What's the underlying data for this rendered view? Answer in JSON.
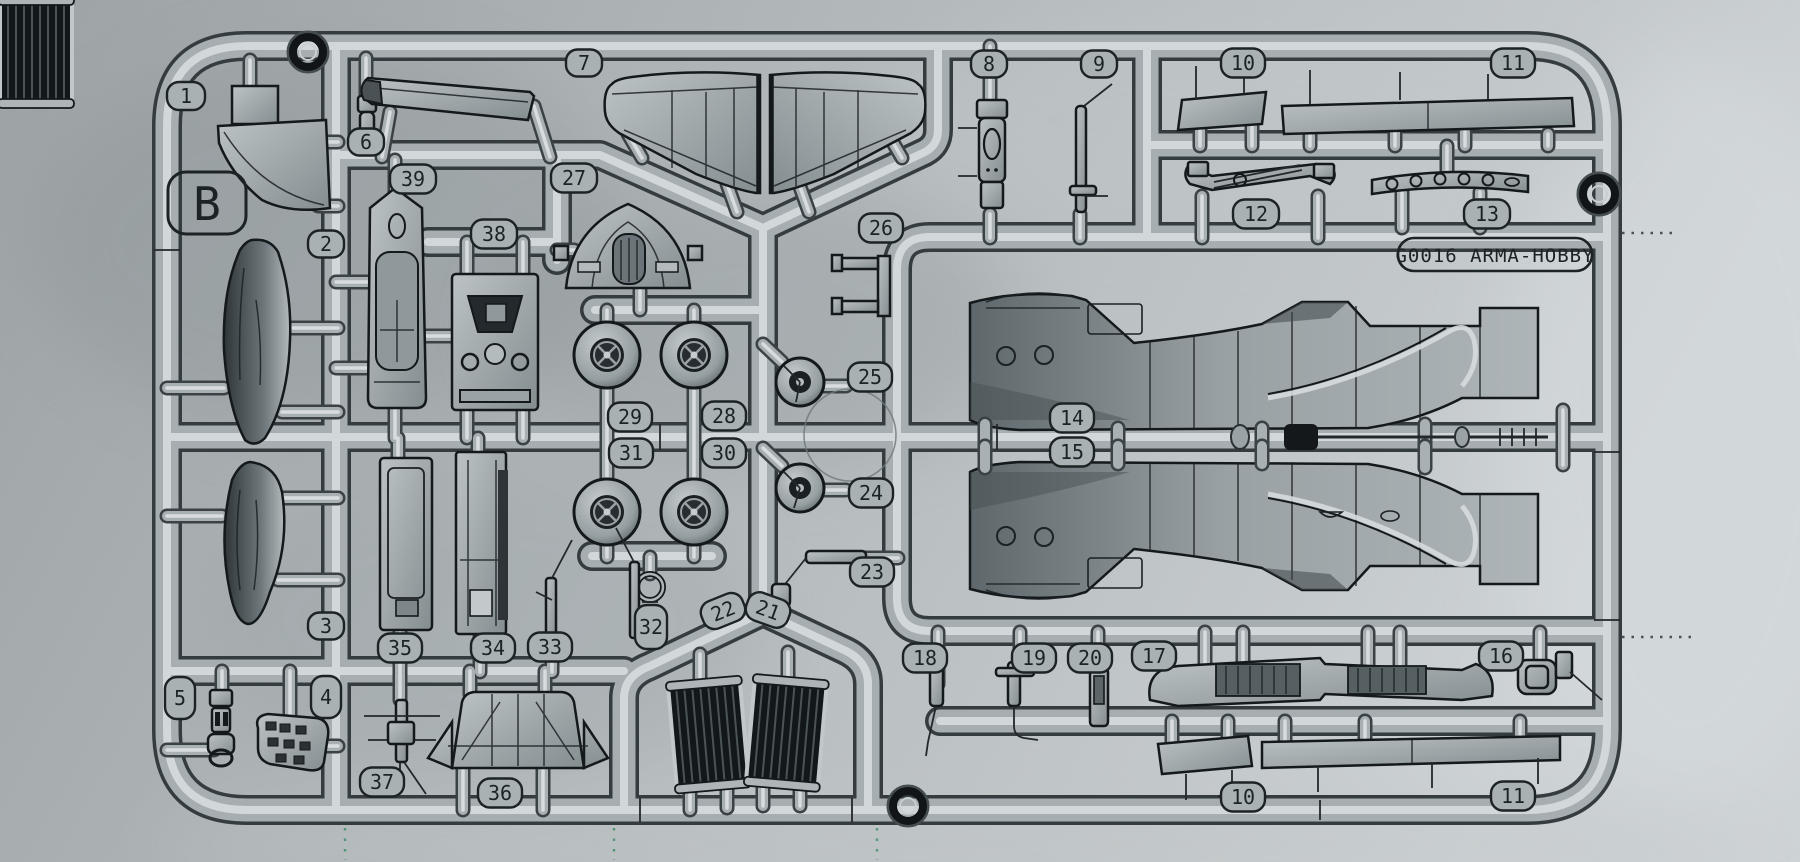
{
  "sprue": {
    "runner_letter": "B",
    "brand_label": "G0016  ARMA-HOBBY",
    "part_tags": [
      {
        "label": "1",
        "x": 186,
        "y": 96,
        "w": 38,
        "h": 28,
        "rot": 0
      },
      {
        "label": "2",
        "x": 326,
        "y": 244,
        "w": 36,
        "h": 27,
        "rot": 0
      },
      {
        "label": "6",
        "x": 366,
        "y": 142,
        "w": 36,
        "h": 27,
        "rot": 0
      },
      {
        "label": "7",
        "x": 584,
        "y": 63,
        "w": 36,
        "h": 27,
        "rot": 0
      },
      {
        "label": "39",
        "x": 413,
        "y": 179,
        "w": 46,
        "h": 29,
        "rot": 0
      },
      {
        "label": "27",
        "x": 574,
        "y": 178,
        "w": 46,
        "h": 29,
        "rot": 0
      },
      {
        "label": "38",
        "x": 494,
        "y": 234,
        "w": 46,
        "h": 29,
        "rot": 0
      },
      {
        "label": "8",
        "x": 989,
        "y": 64,
        "w": 36,
        "h": 27,
        "rot": 0
      },
      {
        "label": "9",
        "x": 1099,
        "y": 64,
        "w": 36,
        "h": 27,
        "rot": 0
      },
      {
        "label": "10",
        "x": 1243,
        "y": 63,
        "w": 44,
        "h": 29,
        "rot": 0
      },
      {
        "label": "11",
        "x": 1513,
        "y": 63,
        "w": 44,
        "h": 29,
        "rot": 0
      },
      {
        "label": "12",
        "x": 1256,
        "y": 214,
        "w": 46,
        "h": 29,
        "rot": 0
      },
      {
        "label": "13",
        "x": 1487,
        "y": 214,
        "w": 46,
        "h": 29,
        "rot": 0
      },
      {
        "label": "26",
        "x": 881,
        "y": 228,
        "w": 44,
        "h": 29,
        "rot": 0
      },
      {
        "label": "25",
        "x": 870,
        "y": 377,
        "w": 44,
        "h": 29,
        "rot": 0
      },
      {
        "label": "29",
        "x": 630,
        "y": 417,
        "w": 44,
        "h": 29,
        "rot": 0
      },
      {
        "label": "28",
        "x": 724,
        "y": 416,
        "w": 44,
        "h": 29,
        "rot": 0
      },
      {
        "label": "31",
        "x": 631,
        "y": 453,
        "w": 44,
        "h": 29,
        "rot": 0
      },
      {
        "label": "30",
        "x": 724,
        "y": 453,
        "w": 44,
        "h": 29,
        "rot": 0
      },
      {
        "label": "14",
        "x": 1072,
        "y": 418,
        "w": 44,
        "h": 29,
        "rot": 0
      },
      {
        "label": "15",
        "x": 1072,
        "y": 452,
        "w": 44,
        "h": 29,
        "rot": 0
      },
      {
        "label": "24",
        "x": 871,
        "y": 493,
        "w": 44,
        "h": 29,
        "rot": 0
      },
      {
        "label": "23",
        "x": 872,
        "y": 572,
        "w": 44,
        "h": 29,
        "rot": 0
      },
      {
        "label": "3",
        "x": 326,
        "y": 626,
        "w": 36,
        "h": 27,
        "rot": 0
      },
      {
        "label": "35",
        "x": 400,
        "y": 648,
        "w": 44,
        "h": 29,
        "rot": 0
      },
      {
        "label": "34",
        "x": 493,
        "y": 648,
        "w": 44,
        "h": 29,
        "rot": 0
      },
      {
        "label": "33",
        "x": 550,
        "y": 647,
        "w": 44,
        "h": 29,
        "rot": 0
      },
      {
        "label": "32",
        "x": 651,
        "y": 627,
        "w": 32,
        "h": 44,
        "rot": 0
      },
      {
        "label": "22",
        "x": 723,
        "y": 611,
        "w": 44,
        "h": 29,
        "rot": -22
      },
      {
        "label": "21",
        "x": 768,
        "y": 610,
        "w": 44,
        "h": 29,
        "rot": 20
      },
      {
        "label": "5",
        "x": 180,
        "y": 698,
        "w": 30,
        "h": 42,
        "rot": 0
      },
      {
        "label": "4",
        "x": 326,
        "y": 697,
        "w": 30,
        "h": 42,
        "rot": 0
      },
      {
        "label": "18",
        "x": 925,
        "y": 658,
        "w": 44,
        "h": 29,
        "rot": 0
      },
      {
        "label": "19",
        "x": 1034,
        "y": 658,
        "w": 44,
        "h": 29,
        "rot": 0
      },
      {
        "label": "20",
        "x": 1090,
        "y": 658,
        "w": 44,
        "h": 29,
        "rot": 0
      },
      {
        "label": "17",
        "x": 1154,
        "y": 656,
        "w": 44,
        "h": 29,
        "rot": 0
      },
      {
        "label": "16",
        "x": 1501,
        "y": 656,
        "w": 44,
        "h": 29,
        "rot": 0
      },
      {
        "label": "37",
        "x": 382,
        "y": 782,
        "w": 44,
        "h": 29,
        "rot": 0
      },
      {
        "label": "36",
        "x": 500,
        "y": 793,
        "w": 44,
        "h": 29,
        "rot": 0
      },
      {
        "label": "10",
        "x": 1243,
        "y": 797,
        "w": 44,
        "h": 29,
        "rot": 0
      },
      {
        "label": "11",
        "x": 1513,
        "y": 796,
        "w": 44,
        "h": 29,
        "rot": 0
      }
    ]
  },
  "colors": {
    "plastic": "#a7aeb1",
    "plastic_highlight": "#d9dee0",
    "plastic_shadow": "#3a4246",
    "outline": "#1c2324",
    "background_left": "#9fa5a7",
    "background_right": "#cdd2d4",
    "radiator_dark": "#12171a",
    "dotted_guide_green": "#3f8f68"
  }
}
